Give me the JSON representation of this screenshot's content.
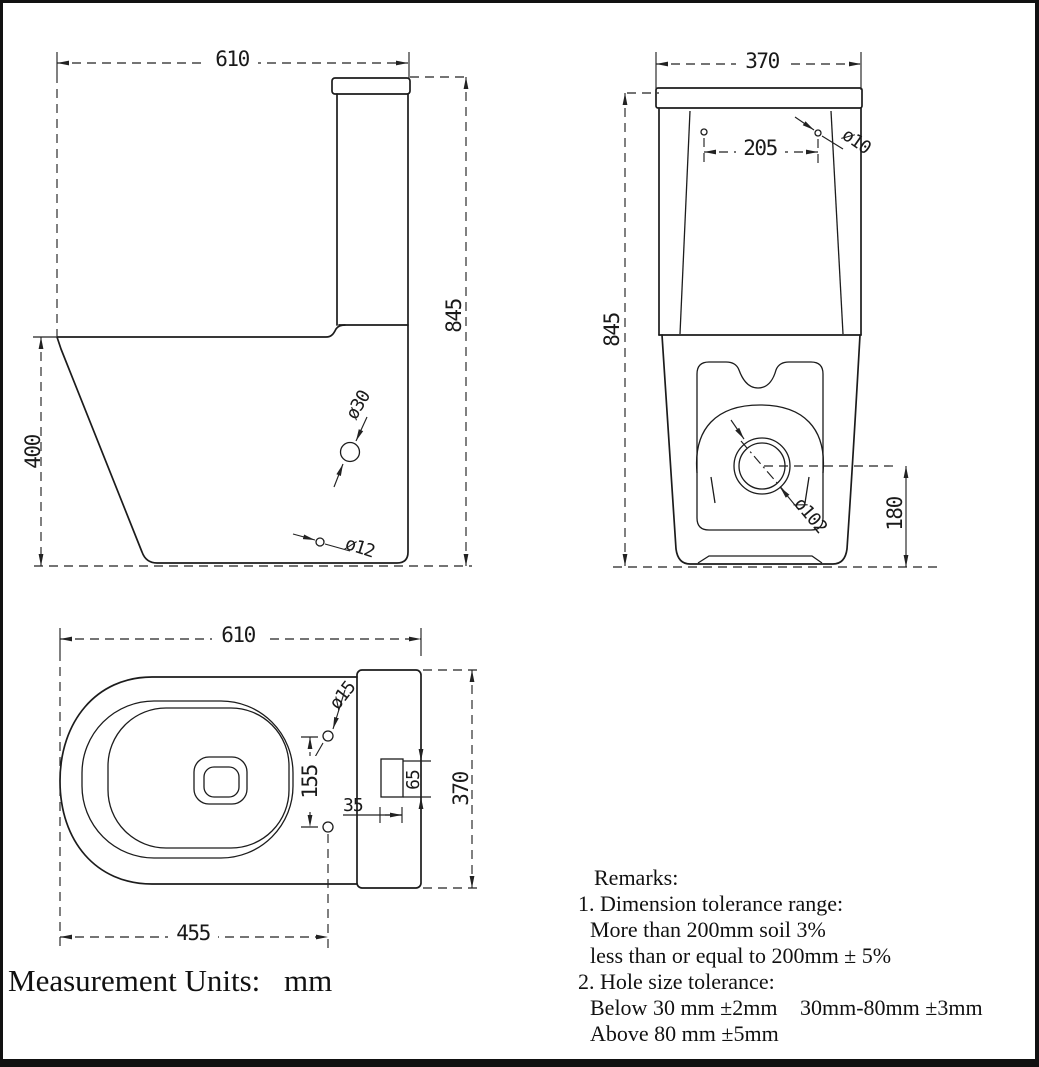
{
  "drawing": {
    "units_label": "Measurement Units:",
    "units_value": "mm",
    "side_view": {
      "width": "610",
      "height": "845",
      "bowl_height": "400",
      "seat_hole": "ø30",
      "fixing_hole": "ø12"
    },
    "front_view": {
      "width": "370",
      "hole_spacing": "205",
      "hole": "ø10",
      "height": "845",
      "outlet": "ø102",
      "outlet_height": "180"
    },
    "top_view": {
      "width": "610",
      "hole": "ø15",
      "hole_spacing": "155",
      "slot_width": "35",
      "slot_height": "65",
      "depth": "370",
      "bowl_length": "455"
    },
    "remarks": {
      "title": "Remarks:",
      "line1": "1. Dimension tolerance range:",
      "line2": "More than 200mm soil 3%",
      "line3": "less than or equal to 200mm ± 5%",
      "line4": "2. Hole size tolerance:",
      "line5a": "Below 30 mm ±2mm",
      "line5b": "30mm-80mm ±3mm",
      "line6": "Above 80 mm ±5mm"
    }
  }
}
